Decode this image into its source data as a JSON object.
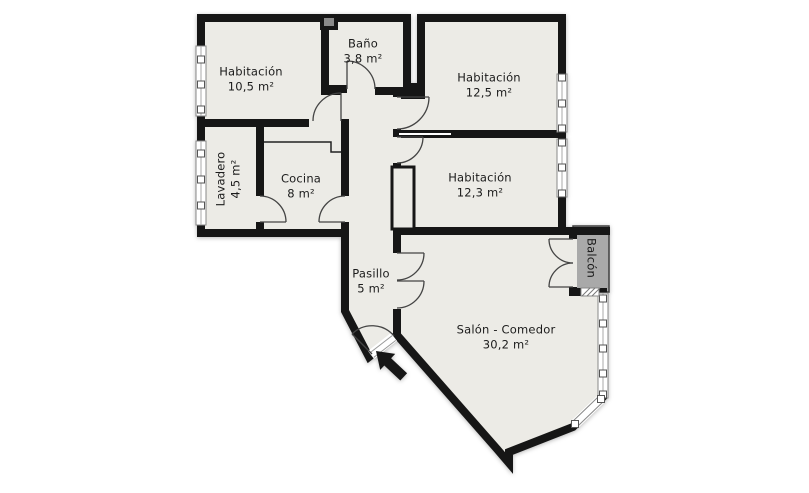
{
  "plan": {
    "rooms": [
      {
        "id": "habitacion-1",
        "name": "Habitación",
        "area": "10,5 m²"
      },
      {
        "id": "bano",
        "name": "Baño",
        "area": "3,8 m²"
      },
      {
        "id": "habitacion-2",
        "name": "Habitación",
        "area": "12,5 m²"
      },
      {
        "id": "lavadero",
        "name": "Lavadero",
        "area": "4,5 m²"
      },
      {
        "id": "cocina",
        "name": "Cocina",
        "area": "8 m²"
      },
      {
        "id": "habitacion-3",
        "name": "Habitación",
        "area": "12,3 m²"
      },
      {
        "id": "pasillo",
        "name": "Pasillo",
        "area": "5 m²"
      },
      {
        "id": "salon-comedor",
        "name": "Salón - Comedor",
        "area": "30,2 m²"
      },
      {
        "id": "balcon",
        "name": "Balcón",
        "area": ""
      }
    ],
    "icons": {
      "entrance_arrow": "entrance-arrow"
    },
    "colors": {
      "wall": "#161616",
      "floor": "#ECEBE6",
      "balcony": "#A9A9A9",
      "background": "#FFFFFF",
      "window_frame": "#888888"
    }
  }
}
